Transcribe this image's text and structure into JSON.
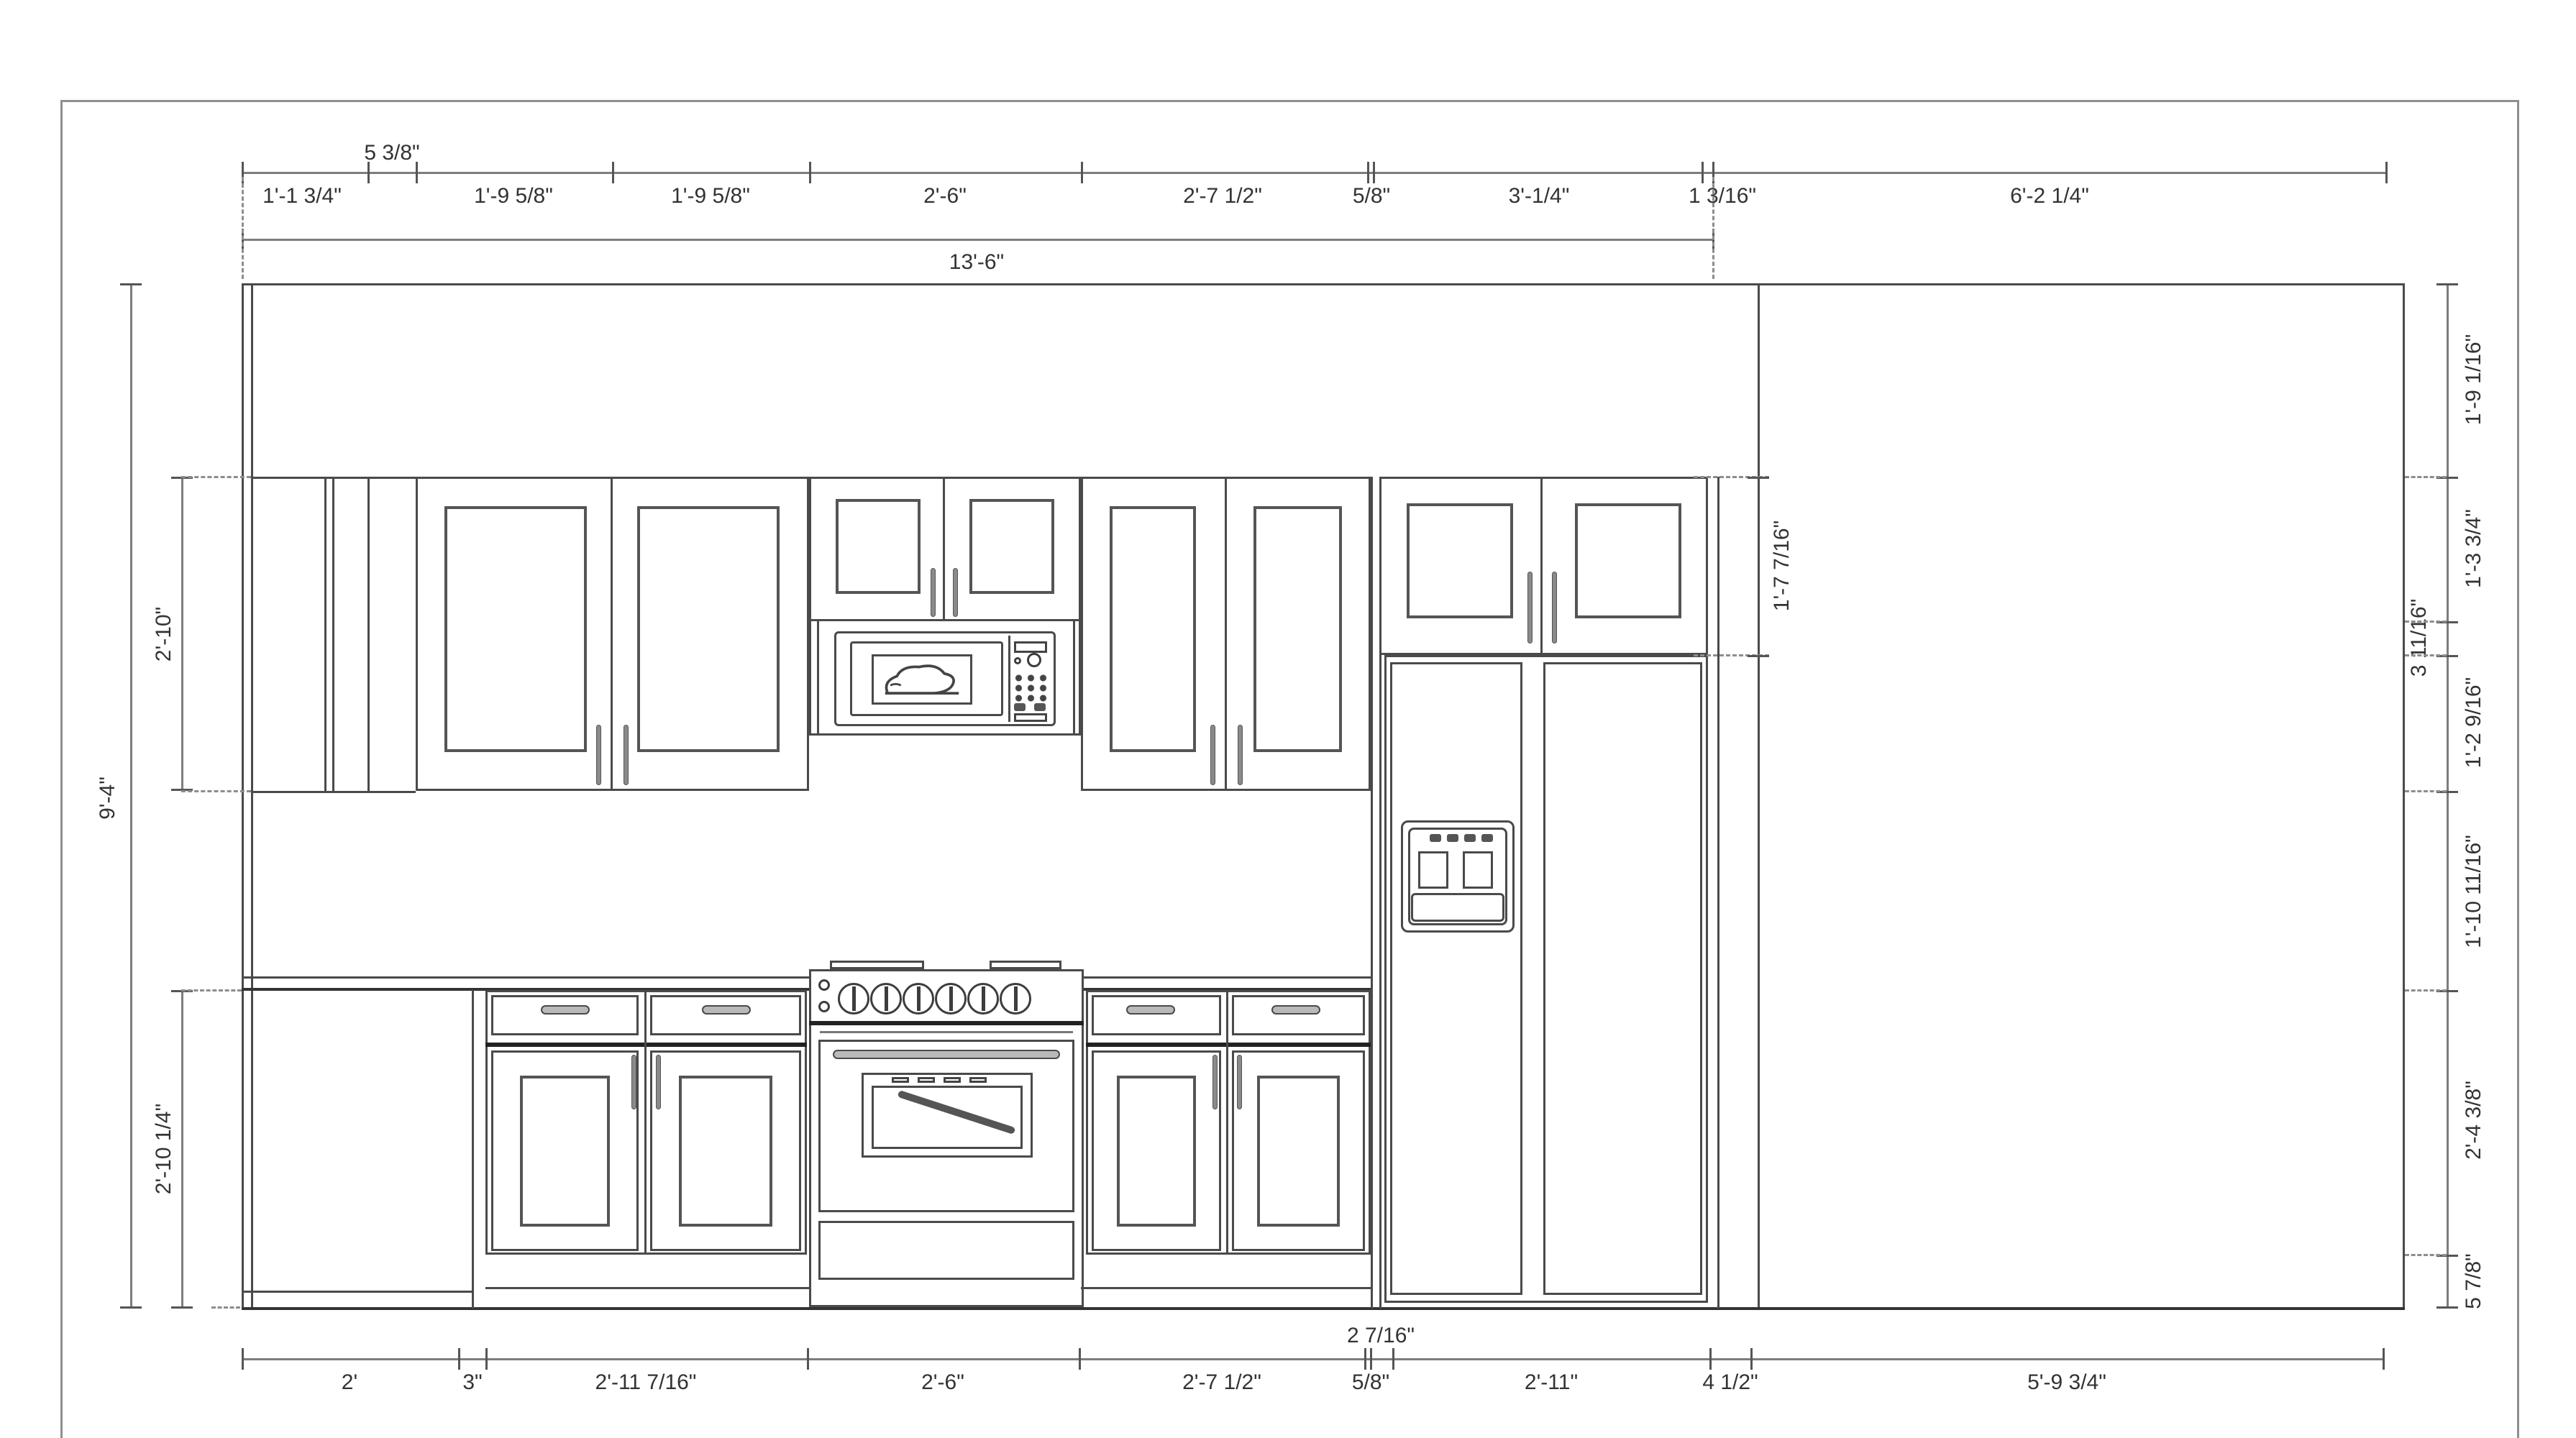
{
  "drawing": {
    "kind": "kitchen-elevation-line-drawing",
    "colors": {
      "line": "#4a4a4a",
      "heavy_line": "#222222",
      "dim_line": "#7d7d7d",
      "dim_text": "#333333",
      "page_border": "#8f8f8f",
      "background": "#ffffff"
    }
  },
  "dims": {
    "top_row": [
      "1'-1 3/4\"",
      "5 3/8\"",
      "1'-9 5/8\"",
      "1'-9 5/8\"",
      "2'-6\"",
      "2'-7 1/2\"",
      "5/8\"",
      "3'-1/4\"",
      "1 3/16\"",
      "6'-2 1/4\""
    ],
    "top_overall": "13'-6\"",
    "bottom_row": [
      "2'",
      "3\"",
      "2'-11 7/16\"",
      "2'-6\"",
      "2'-7 1/2\"",
      "5/8\"",
      "2 7/16\"",
      "2'-11\"",
      "4 1/2\"",
      "5'-9 3/4\""
    ],
    "left_column": [
      "9'-4\"",
      "2'-10\"",
      "2'-10 1/4\""
    ],
    "right_column": [
      "1'-9 1/16\"",
      "1'-3 3/4\"",
      "3 11/16\"",
      "1'-2 9/16\"",
      "1'-10 11/16\"",
      "2'-4 3/8\"",
      "5 7/8\""
    ],
    "fridge_cabinet_height": "1'-7 7/16\""
  }
}
